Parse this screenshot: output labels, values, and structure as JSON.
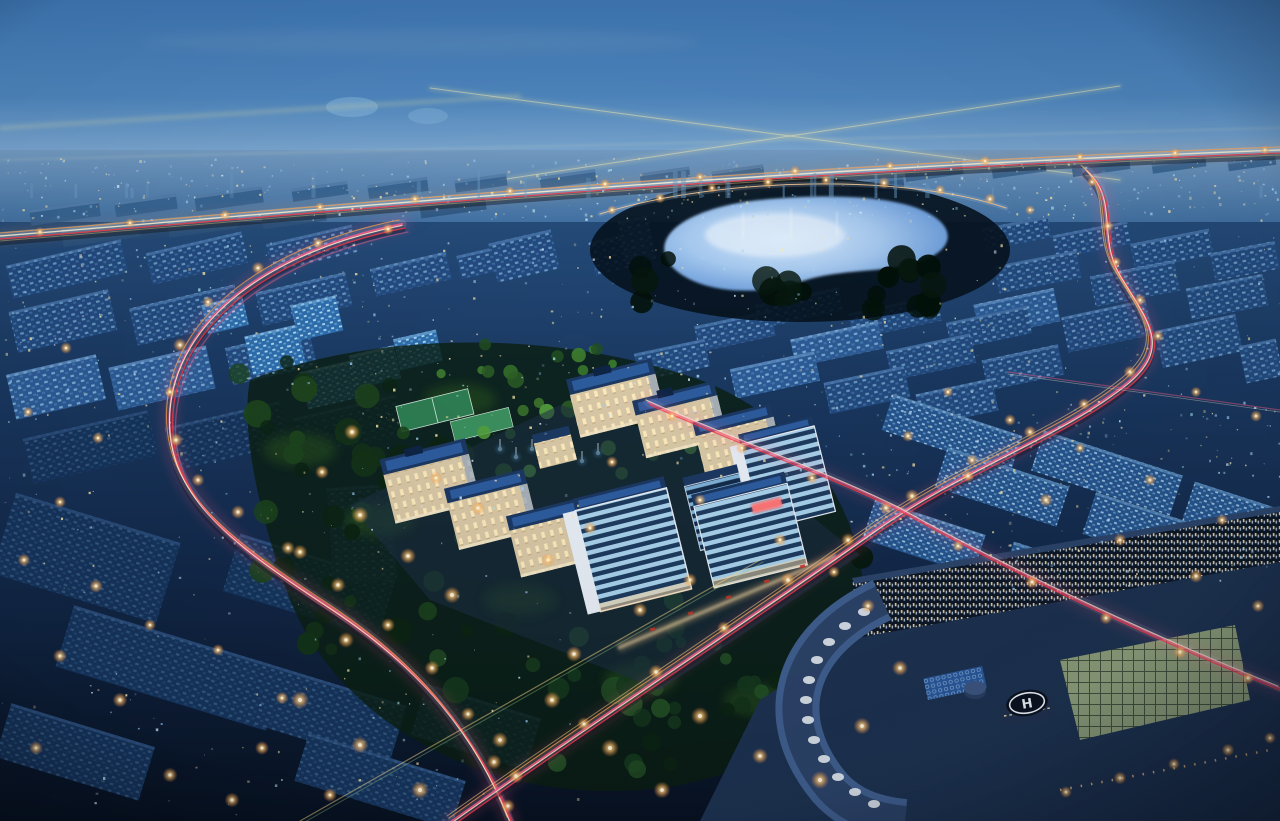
{
  "meta": {
    "title": "Aerial night render of a city development",
    "description": "Dusk aerial perspective render: blue city blocks, glowing lake, illuminated campus, highways with light trails, curved building with helipad"
  },
  "palette": {
    "sky_top": "#3f78b5",
    "sky_mid": "#5e94c7",
    "sky_horizon": "#8fb6da",
    "ground_top": "#2a5586",
    "ground_mid": "#13294a",
    "ground_bottom": "#071120",
    "roof_dark": "#1c3963",
    "roof_blue": "#2d5c9e",
    "cream": "#d8c8a6",
    "cream_shade": "#93a5bd",
    "frame_white": "#e8eef5",
    "lake_core": "#d6ebff",
    "lake_mid": "#7fb0e8",
    "lake_edge": "#39699f",
    "trail_pink": "#ff5f8a",
    "trail_red": "#ff3848",
    "trail_orange": "#ffa24d",
    "trail_white": "#fff3d6",
    "trail_yellow": "#ffe28a",
    "road_pale": "#c3d6e8",
    "lamp_core": "#fff3d8",
    "lamp_halo": "#ff9d4d",
    "glass_green": "#97a87e",
    "hosp_roof": "#2c456b",
    "led_red": "#ff3b3b",
    "fountain": "#bfefff"
  },
  "helipad": {
    "label": "H"
  },
  "scene": {
    "speckle_seed": 1337,
    "speckle_colors": [
      "#d7ecff",
      "#aee3f0",
      "#ffedb0",
      "#9fd0ff",
      "#ffe9a8"
    ],
    "speckle_regions": [
      {
        "name": "distant-band",
        "x": 0,
        "y": 158,
        "w": 1280,
        "h": 62,
        "n": 420,
        "type": "dot"
      },
      {
        "name": "distant-towers",
        "x": 20,
        "y": 150,
        "w": 1240,
        "h": 48,
        "n": 26,
        "type": "tower"
      },
      {
        "name": "mid-left",
        "x": 0,
        "y": 238,
        "w": 600,
        "h": 190,
        "n": 200,
        "type": "dot"
      },
      {
        "name": "mid-right",
        "x": 600,
        "y": 225,
        "w": 680,
        "h": 250,
        "n": 230,
        "type": "dot"
      },
      {
        "name": "bottom-left",
        "x": 0,
        "y": 430,
        "w": 580,
        "h": 385,
        "n": 170,
        "type": "dot"
      },
      {
        "name": "bottom-right",
        "x": 850,
        "y": 400,
        "w": 430,
        "h": 190,
        "n": 150,
        "type": "dot"
      }
    ],
    "slabs": [
      [
        30,
        205,
        70,
        16,
        -8,
        "far"
      ],
      [
        115,
        198,
        62,
        15,
        -8,
        "far"
      ],
      [
        195,
        191,
        68,
        16,
        -8,
        "far"
      ],
      [
        292,
        185,
        56,
        13,
        -8,
        "far"
      ],
      [
        368,
        181,
        60,
        14,
        -8,
        "far"
      ],
      [
        455,
        177,
        52,
        12,
        -8,
        "far"
      ],
      [
        540,
        173,
        56,
        12,
        -8,
        "far"
      ],
      [
        640,
        170,
        50,
        11,
        -8,
        "far"
      ],
      [
        712,
        168,
        52,
        11,
        -8,
        "far"
      ],
      [
        905,
        166,
        58,
        12,
        -8,
        "far"
      ],
      [
        992,
        164,
        54,
        11,
        -8,
        "far"
      ],
      [
        1072,
        162,
        58,
        11,
        -8,
        "far"
      ],
      [
        1152,
        160,
        54,
        10,
        -8,
        "far"
      ],
      [
        1228,
        158,
        48,
        10,
        -8,
        "far"
      ],
      [
        62,
        224,
        78,
        18,
        -8,
        "far2"
      ],
      [
        168,
        217,
        70,
        16,
        -8,
        "far2"
      ],
      [
        262,
        210,
        64,
        15,
        -8,
        "far2"
      ],
      [
        420,
        200,
        66,
        14,
        -8,
        "far2"
      ],
      [
        760,
        185,
        58,
        12,
        -8,
        "far2"
      ],
      [
        850,
        180,
        54,
        12,
        -8,
        "far2"
      ],
      [
        8,
        252,
        118,
        34,
        -13,
        "mid"
      ],
      [
        148,
        242,
        98,
        32,
        -13,
        "mid"
      ],
      [
        268,
        234,
        88,
        28,
        -13,
        "mid"
      ],
      [
        12,
        300,
        102,
        42,
        -13,
        "mid"
      ],
      [
        132,
        296,
        108,
        38,
        -13,
        "mid"
      ],
      [
        258,
        282,
        92,
        34,
        -13,
        "mid"
      ],
      [
        372,
        260,
        78,
        28,
        -13,
        "mid"
      ],
      [
        458,
        248,
        68,
        24,
        -13,
        "mid"
      ],
      [
        10,
        364,
        92,
        46,
        -13,
        "midB"
      ],
      [
        112,
        356,
        100,
        44,
        -13,
        "midB"
      ],
      [
        228,
        338,
        86,
        38,
        -13,
        "mid"
      ],
      [
        492,
        236,
        64,
        40,
        -13,
        "mid"
      ],
      [
        204,
        300,
        42,
        30,
        -13,
        "cube"
      ],
      [
        248,
        330,
        54,
        40,
        -13,
        "cube"
      ],
      [
        294,
        300,
        46,
        36,
        -13,
        "cube"
      ],
      [
        303,
        366,
        52,
        38,
        -13,
        "cube"
      ],
      [
        352,
        350,
        46,
        34,
        -13,
        "cube"
      ],
      [
        396,
        334,
        44,
        32,
        -13,
        "cube"
      ],
      [
        592,
        236,
        56,
        34,
        -12,
        "mid"
      ],
      [
        622,
        218,
        30,
        44,
        -12,
        "midB"
      ],
      [
        984,
        222,
        66,
        22,
        -11,
        "mid"
      ],
      [
        1054,
        228,
        76,
        24,
        -11,
        "mid"
      ],
      [
        1132,
        236,
        80,
        27,
        -11,
        "mid"
      ],
      [
        1212,
        247,
        66,
        28,
        -11,
        "mid"
      ],
      [
        996,
        258,
        84,
        28,
        -11,
        "mid"
      ],
      [
        1092,
        268,
        86,
        31,
        -11,
        "mid"
      ],
      [
        1188,
        281,
        78,
        32,
        -11,
        "mid"
      ],
      [
        976,
        296,
        82,
        34,
        -12,
        "midB"
      ],
      [
        1064,
        308,
        86,
        36,
        -12,
        "mid"
      ],
      [
        1158,
        322,
        82,
        38,
        -12,
        "mid"
      ],
      [
        1242,
        342,
        38,
        38,
        -12,
        "mid"
      ],
      [
        756,
        296,
        86,
        24,
        -12,
        "mid"
      ],
      [
        850,
        304,
        90,
        26,
        -12,
        "mid"
      ],
      [
        948,
        314,
        82,
        28,
        -12,
        "mid"
      ],
      [
        696,
        318,
        78,
        26,
        -12,
        "mid"
      ],
      [
        792,
        330,
        90,
        28,
        -12,
        "midB"
      ],
      [
        888,
        342,
        86,
        30,
        -12,
        "mid"
      ],
      [
        984,
        352,
        78,
        31,
        -12,
        "mid"
      ],
      [
        636,
        346,
        72,
        28,
        -12,
        "mid"
      ],
      [
        732,
        360,
        86,
        30,
        -12,
        "midB"
      ],
      [
        826,
        374,
        82,
        32,
        -12,
        "mid"
      ],
      [
        918,
        386,
        78,
        33,
        -12,
        "mid"
      ],
      [
        26,
        424,
        128,
        46,
        -13,
        "darkL"
      ],
      [
        168,
        414,
        118,
        44,
        -13,
        "darkL"
      ],
      [
        296,
        406,
        106,
        42,
        -13,
        "darkL"
      ],
      [
        0,
        516,
        172,
        84,
        17,
        "darkL"
      ],
      [
        60,
        636,
        220,
        64,
        17,
        "darkL"
      ],
      [
        0,
        724,
        150,
        56,
        17,
        "darkL"
      ],
      [
        228,
        556,
        162,
        60,
        17,
        "darkL"
      ],
      [
        206,
        676,
        196,
        62,
        17,
        "darkL"
      ],
      [
        298,
        756,
        164,
        50,
        17,
        "darkL"
      ],
      [
        416,
        700,
        120,
        54,
        17,
        "darkL"
      ],
      [
        330,
        486,
        64,
        96,
        -4,
        "darkT"
      ],
      [
        884,
        414,
        136,
        38,
        18,
        "brightR"
      ],
      [
        1034,
        452,
        146,
        42,
        18,
        "brightR"
      ],
      [
        1186,
        496,
        100,
        42,
        18,
        "brightR"
      ],
      [
        938,
        466,
        128,
        42,
        18,
        "brightR"
      ],
      [
        1086,
        512,
        136,
        44,
        18,
        "brightR"
      ],
      [
        866,
        516,
        116,
        42,
        18,
        "brightR"
      ],
      [
        1004,
        560,
        126,
        44,
        18,
        "brightR"
      ],
      [
        1146,
        606,
        110,
        42,
        18,
        "brightR"
      ],
      [
        1242,
        556,
        44,
        38,
        18,
        "brightR"
      ]
    ],
    "tree_colors_dark": [
      "#03110a",
      "#07180e",
      "#0c2413"
    ],
    "tree_regions": [
      {
        "x": 640,
        "y": 256,
        "w": 330,
        "h": 54,
        "n": 22,
        "colors": [
          "#03110a",
          "#07180e"
        ],
        "rmin": 7,
        "rmax": 16
      },
      {
        "x": 230,
        "y": 360,
        "w": 250,
        "h": 120,
        "n": 20,
        "colors": [
          "#0c2413",
          "#143318",
          "#1d451d"
        ],
        "rmin": 6,
        "rmax": 14
      },
      {
        "x": 250,
        "y": 470,
        "w": 220,
        "h": 180,
        "n": 18,
        "colors": [
          "#0c2413",
          "#143318",
          "#1d451d"
        ],
        "rmin": 6,
        "rmax": 14
      },
      {
        "x": 430,
        "y": 600,
        "w": 300,
        "h": 170,
        "n": 22,
        "colors": [
          "#0c2413",
          "#16381d",
          "#224d24"
        ],
        "rmin": 6,
        "rmax": 15
      },
      {
        "x": 700,
        "y": 640,
        "w": 200,
        "h": 120,
        "n": 14,
        "colors": [
          "#0c2413",
          "#143318"
        ],
        "rmin": 6,
        "rmax": 13
      },
      {
        "x": 860,
        "y": 556,
        "w": 180,
        "h": 90,
        "n": 10,
        "colors": [
          "#07180e",
          "#0c2413"
        ],
        "rmin": 6,
        "rmax": 12
      },
      {
        "x": 430,
        "y": 336,
        "w": 200,
        "h": 44,
        "n": 12,
        "colors": [
          "#224d24",
          "#2c5d26",
          "#3c7a2e"
        ],
        "rmin": 4,
        "rmax": 9
      },
      {
        "x": 468,
        "y": 402,
        "w": 230,
        "h": 74,
        "n": 20,
        "colors": [
          "#2c5d26",
          "#3f7a2e",
          "#55a03d"
        ],
        "rmin": 4,
        "rmax": 9
      },
      {
        "x": 560,
        "y": 636,
        "w": 240,
        "h": 60,
        "n": 10,
        "colors": [
          "#16381d",
          "#224d24"
        ],
        "rmin": 5,
        "rmax": 10
      }
    ],
    "lawn_glows": [
      [
        300,
        450
      ],
      [
        380,
        520
      ],
      [
        520,
        600
      ],
      [
        640,
        680
      ],
      [
        760,
        700
      ],
      [
        460,
        400
      ]
    ],
    "fountain_jets": [
      [
        500,
        448
      ],
      [
        516,
        456
      ],
      [
        532,
        448
      ],
      [
        548,
        458
      ],
      [
        566,
        450
      ],
      [
        582,
        460
      ],
      [
        598,
        452
      ]
    ],
    "street_lights": [
      [
        40,
        232,
        0.5
      ],
      [
        130,
        223,
        0.5
      ],
      [
        225,
        215,
        0.55
      ],
      [
        320,
        207,
        0.5
      ],
      [
        415,
        199,
        0.55
      ],
      [
        510,
        191,
        0.5
      ],
      [
        605,
        184,
        0.55
      ],
      [
        700,
        177,
        0.5
      ],
      [
        795,
        171,
        0.55
      ],
      [
        890,
        166,
        0.5
      ],
      [
        985,
        161,
        0.55
      ],
      [
        1080,
        157,
        0.5
      ],
      [
        1175,
        153,
        0.55
      ],
      [
        1265,
        150,
        0.5
      ],
      [
        612,
        210,
        0.5
      ],
      [
        660,
        198,
        0.55
      ],
      [
        712,
        188,
        0.5
      ],
      [
        768,
        182,
        0.6
      ],
      [
        826,
        180,
        0.55
      ],
      [
        884,
        183,
        0.6
      ],
      [
        940,
        190,
        0.55
      ],
      [
        990,
        199,
        0.6
      ],
      [
        1030,
        210,
        0.5
      ],
      [
        388,
        229,
        0.6
      ],
      [
        318,
        243,
        0.6
      ],
      [
        258,
        268,
        0.65
      ],
      [
        208,
        302,
        0.6
      ],
      [
        180,
        345,
        0.7
      ],
      [
        170,
        392,
        0.6
      ],
      [
        176,
        440,
        0.7
      ],
      [
        198,
        480,
        0.65
      ],
      [
        238,
        512,
        0.7
      ],
      [
        288,
        548,
        0.7
      ],
      [
        338,
        585,
        0.75
      ],
      [
        388,
        625,
        0.7
      ],
      [
        432,
        668,
        0.75
      ],
      [
        468,
        714,
        0.7
      ],
      [
        494,
        762,
        0.75
      ],
      [
        508,
        806,
        0.7
      ],
      [
        1092,
        182,
        0.5
      ],
      [
        1108,
        226,
        0.6
      ],
      [
        1116,
        262,
        0.55
      ],
      [
        1140,
        300,
        0.6
      ],
      [
        1158,
        336,
        0.6
      ],
      [
        1130,
        372,
        0.65
      ],
      [
        1084,
        404,
        0.6
      ],
      [
        1030,
        432,
        0.65
      ],
      [
        972,
        460,
        0.6
      ],
      [
        912,
        496,
        0.7
      ],
      [
        848,
        540,
        0.7
      ],
      [
        788,
        580,
        0.75
      ],
      [
        724,
        628,
        0.7
      ],
      [
        656,
        672,
        0.75
      ],
      [
        584,
        724,
        0.7
      ],
      [
        516,
        776,
        0.75
      ],
      [
        672,
        416,
        0.55
      ],
      [
        742,
        448,
        0.6
      ],
      [
        812,
        478,
        0.6
      ],
      [
        886,
        508,
        0.65
      ],
      [
        958,
        546,
        0.6
      ],
      [
        1032,
        582,
        0.7
      ],
      [
        1106,
        618,
        0.65
      ],
      [
        1180,
        652,
        0.7
      ],
      [
        1248,
        678,
        0.65
      ],
      [
        352,
        432,
        0.8
      ],
      [
        322,
        472,
        0.7
      ],
      [
        360,
        515,
        0.85
      ],
      [
        300,
        552,
        0.75
      ],
      [
        408,
        556,
        0.8
      ],
      [
        452,
        595,
        0.85
      ],
      [
        346,
        640,
        0.8
      ],
      [
        300,
        700,
        0.9
      ],
      [
        360,
        745,
        0.85
      ],
      [
        420,
        790,
        0.9
      ],
      [
        500,
        740,
        0.8
      ],
      [
        552,
        700,
        0.85
      ],
      [
        610,
        748,
        0.9
      ],
      [
        662,
        790,
        0.85
      ],
      [
        700,
        716,
        0.9
      ],
      [
        760,
        756,
        0.8
      ],
      [
        820,
        780,
        0.9
      ],
      [
        862,
        726,
        0.85
      ],
      [
        900,
        668,
        0.8
      ],
      [
        574,
        654,
        0.8
      ],
      [
        640,
        610,
        0.75
      ],
      [
        690,
        580,
        0.7
      ],
      [
        548,
        560,
        0.7
      ],
      [
        590,
        528,
        0.65
      ],
      [
        478,
        508,
        0.7
      ],
      [
        436,
        478,
        0.65
      ],
      [
        908,
        436,
        0.6
      ],
      [
        968,
        476,
        0.65
      ],
      [
        1046,
        500,
        0.7
      ],
      [
        1120,
        540,
        0.65
      ],
      [
        1196,
        576,
        0.7
      ],
      [
        1258,
        606,
        0.65
      ],
      [
        1222,
        520,
        0.6
      ],
      [
        1150,
        480,
        0.6
      ],
      [
        1080,
        448,
        0.55
      ],
      [
        1010,
        420,
        0.6
      ],
      [
        948,
        392,
        0.55
      ],
      [
        1256,
        416,
        0.6
      ],
      [
        1196,
        392,
        0.55
      ],
      [
        66,
        348,
        0.6
      ],
      [
        28,
        412,
        0.55
      ],
      [
        98,
        438,
        0.6
      ],
      [
        60,
        502,
        0.6
      ],
      [
        24,
        560,
        0.65
      ],
      [
        96,
        586,
        0.7
      ],
      [
        150,
        625,
        0.6
      ],
      [
        60,
        656,
        0.7
      ],
      [
        120,
        700,
        0.75
      ],
      [
        36,
        748,
        0.7
      ],
      [
        170,
        775,
        0.75
      ],
      [
        262,
        748,
        0.7
      ],
      [
        232,
        800,
        0.75
      ],
      [
        330,
        795,
        0.7
      ],
      [
        282,
        698,
        0.65
      ],
      [
        218,
        650,
        0.6
      ],
      [
        1066,
        792,
        0.6
      ],
      [
        1120,
        778,
        0.65
      ],
      [
        1174,
        764,
        0.6
      ],
      [
        1228,
        750,
        0.65
      ],
      [
        1270,
        738,
        0.6
      ],
      [
        612,
        462,
        0.6
      ],
      [
        700,
        500,
        0.6
      ],
      [
        780,
        540,
        0.65
      ],
      [
        834,
        572,
        0.6
      ],
      [
        868,
        606,
        0.7
      ]
    ]
  }
}
